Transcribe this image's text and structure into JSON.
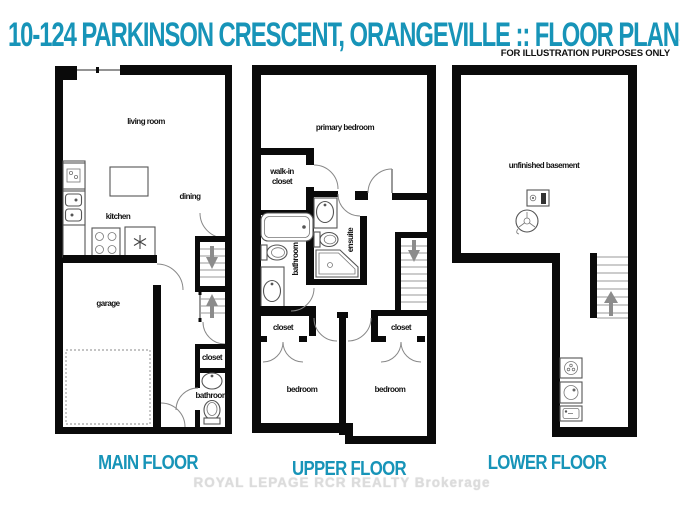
{
  "header": {
    "title": "10-124 PARKINSON CRESCENT, ORANGEVILLE :: FLOOR PLANS",
    "disclaimer": "FOR ILLUSTRATION PURPOSES ONLY"
  },
  "watermark": {
    "text": "ROYAL LEPAGE RCR REALTY  Brokerage"
  },
  "colors": {
    "accent": "#1794b8",
    "wall": "#0a0a0a",
    "arrow": "#8c8c8c",
    "watermark": "#dcdcdc"
  },
  "floors": {
    "main": {
      "label": "MAIN FLOOR",
      "rooms": {
        "living_room": "living room",
        "kitchen": "kitchen",
        "dining": "dining",
        "garage": "garage",
        "closet": "closet",
        "bathroom": "bathroom"
      }
    },
    "upper": {
      "label": "UPPER FLOOR",
      "rooms": {
        "primary_bedroom": "primary bedroom",
        "walk_in_line1": "walk-in",
        "walk_in_line2": "closet",
        "bathroom": "bathroom",
        "ensuite": "ensuite",
        "closet_left": "closet",
        "closet_right": "closet",
        "bedroom_left": "bedroom",
        "bedroom_right": "bedroom"
      }
    },
    "lower": {
      "label": "LOWER FLOOR",
      "rooms": {
        "basement": "unfinished basement"
      }
    }
  }
}
